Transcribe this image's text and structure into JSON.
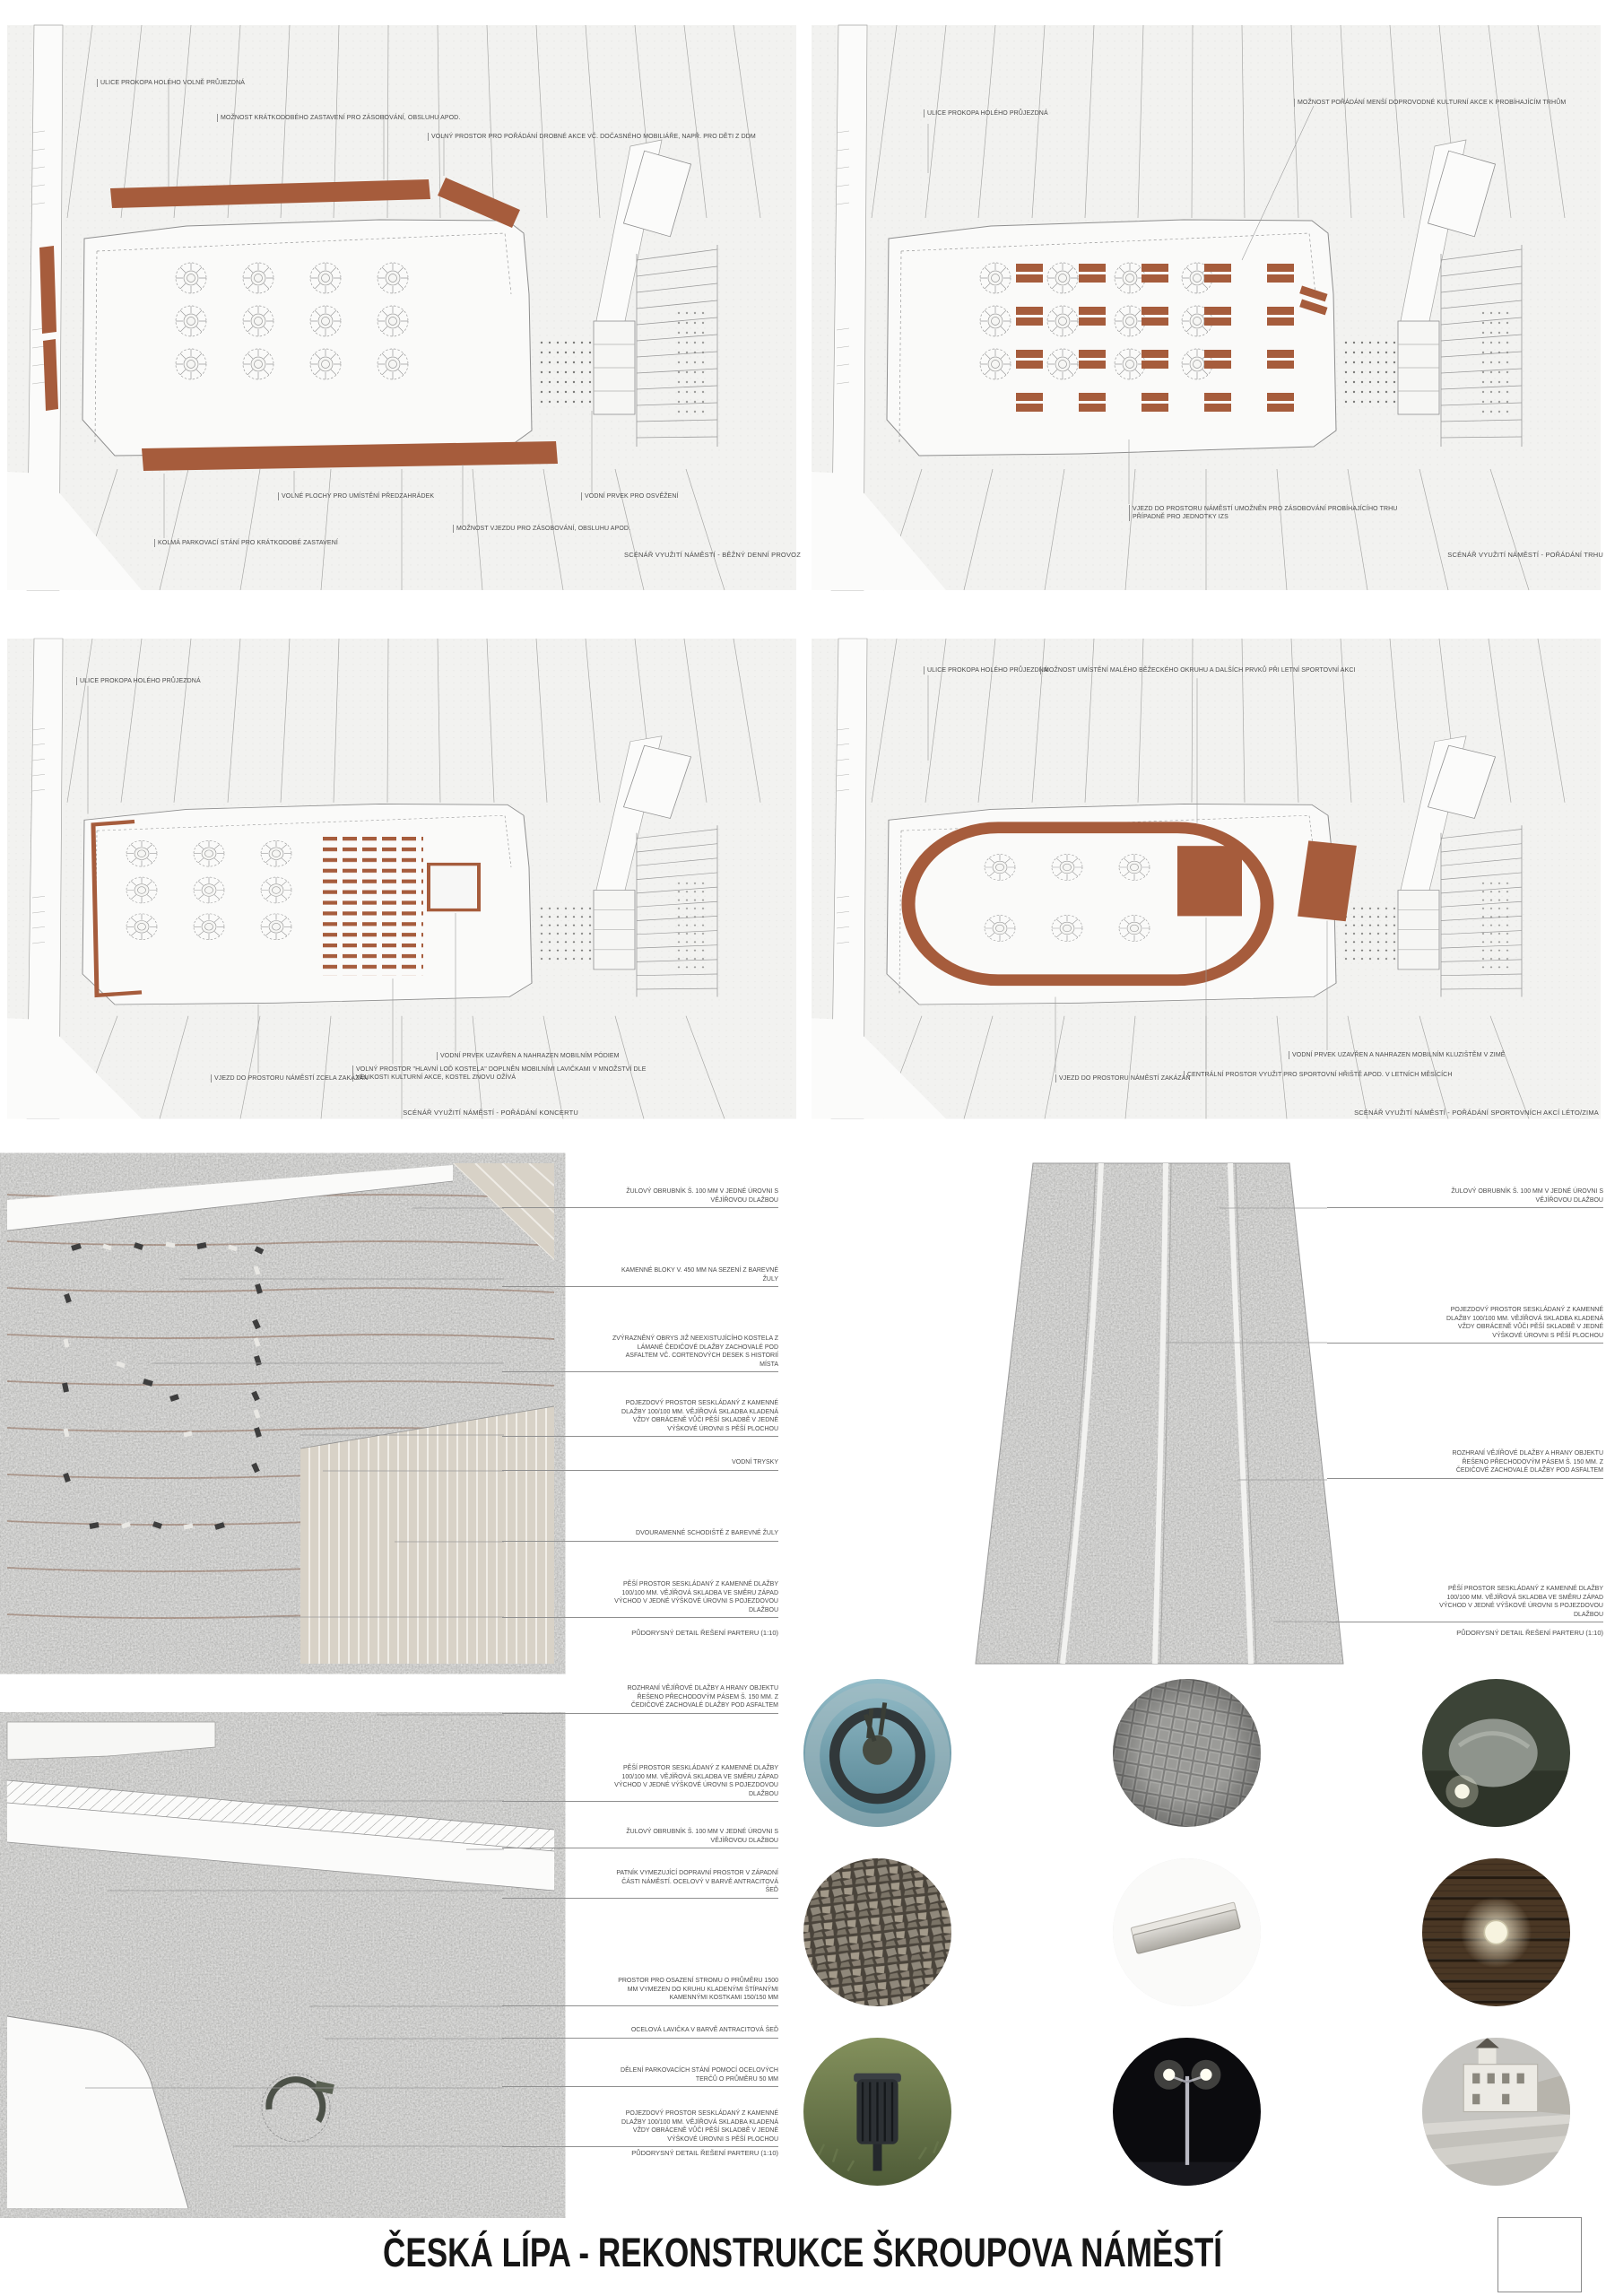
{
  "board": {
    "title": "ČESKÁ LÍPA - REKONSTRUKCE ŠKROUPOVA NÁMĚSTÍ",
    "colors": {
      "accent": "#A65C3C",
      "plan_background": "#F2F2F0",
      "label_text": "#4B4B4B",
      "granite_gray": "#9A9A97",
      "stair_beige": "#D8D2C7"
    }
  },
  "scenarios": [
    {
      "name": "bezny-denni-provoz",
      "caption": "SCÉNÁŘ VYUŽITÍ NÁMĚSTÍ - BĚŽNÝ DENNÍ PROVOZ",
      "labels": [
        "ULICE PROKOPA HOLÉHO VOLNĚ PRŮJEZDNÁ",
        "MOŽNOST KRÁTKODOBÉHO ZASTAVENÍ PRO ZÁSOBOVÁNÍ, OBSLUHU APOD.",
        "VOLNÝ PROSTOR PRO POŘÁDÁNÍ DROBNÉ AKCE VČ. DOČASNÉHO MOBILIÁŘE, NAPŘ. PRO DĚTI Z DDM",
        "VOLNÉ PLOCHY PRO UMÍSTĚNÍ PŘEDZAHRÁDEK",
        "VODNÍ PRVEK PRO OSVĚŽENÍ",
        "MOŽNOST VJEZDU PRO ZÁSOBOVÁNÍ, OBSLUHU APOD.",
        "KOLMÁ PARKOVACÍ STÁNÍ PRO KRÁTKODOBÉ ZASTAVENÍ"
      ]
    },
    {
      "name": "poradani-trhu",
      "caption": "SCÉNÁŘ VYUŽITÍ NÁMĚSTÍ - POŘÁDÁNÍ TRHU",
      "labels": [
        "ULICE PROKOPA HOLÉHO PRŮJEZDNÁ",
        "MOŽNOST POŘÁDÁNÍ MENŠÍ DOPROVODNÉ KULTURNÍ AKCE K PROBÍHAJÍCÍM TRHŮM",
        "VJEZD DO PROSTORU NÁMĚSTÍ UMOŽNĚN PRO ZÁSOBOVÁNÍ PROBÍHAJÍCÍHO TRHU PŘÍPADNĚ PRO JEDNOTKY IZS"
      ]
    },
    {
      "name": "poradani-koncertu",
      "caption": "SCÉNÁŘ VYUŽITÍ NÁMĚSTÍ - POŘÁDÁNÍ KONCERTU",
      "labels": [
        "ULICE PROKOPA HOLÉHO PRŮJEZDNÁ",
        "VJEZD DO PROSTORU NÁMĚSTÍ ZCELA ZAKÁZÁN",
        "VOLNÝ PROSTOR \"HLAVNÍ LOĎ KOSTELA\" DOPLNĚN MOBILNÍMI LAVIČKAMI V MNOŽSTVÍ DLE VELIKOSTI KULTURNÍ AKCE, KOSTEL ZNOVU OŽÍVÁ",
        "VODNÍ PRVEK UZAVŘEN A NAHRAZEN MOBILNÍM PÓDIEM"
      ]
    },
    {
      "name": "poradani-sportovnich-akci",
      "caption": "SCÉNÁŘ VYUŽITÍ NÁMĚSTÍ - POŘÁDÁNÍ SPORTOVNÍCH AKCÍ LÉTO/ZIMA",
      "labels": [
        "ULICE PROKOPA HOLÉHO PRŮJEZDNÁ",
        "MOŽNOST UMÍSTĚNÍ MALÉHO BĚŽECKÉHO OKRUHU A DALŠÍCH PRVKŮ PŘI LETNÍ SPORTOVNÍ AKCI",
        "VJEZD DO PROSTORU NÁMĚSTÍ ZAKÁZÁN",
        "CENTRÁLNÍ PROSTOR VYUŽIT PRO SPORTOVNÍ HŘIŠTĚ APOD. V LETNÍCH MĚSÍCÍCH",
        "VODNÍ PRVEK UZAVŘEN A NAHRAZEN MOBILNÍM KLUZIŠTĚM V ZIMĚ"
      ]
    }
  ],
  "details": [
    {
      "name": "detail-parteru-zapad",
      "caption": "PŮDORYSNÝ DETAIL ŘEŠENÍ PARTERU (1:10)",
      "labels": [
        "ŽULOVÝ OBRUBNÍK Š. 100 MM V JEDNÉ ÚROVNI S VĚJÍŘOVOU DLAŽBOU",
        "KAMENNÉ BLOKY V. 450 MM NA SEZENÍ Z BAREVNÉ ŽULY",
        "ZVÝRAZNĚNÝ OBRYS JIŽ NEEXISTUJÍCÍHO KOSTELA Z LÁMANÉ ČEDIČOVÉ DLAŽBY ZACHOVALÉ POD ASFALTEM VČ. CORTENOVÝCH DESEK S HISTORIÍ MÍSTA",
        "POJEZDOVÝ PROSTOR SESKLÁDANÝ Z KAMENNÉ DLAŽBY 100/100 MM. VĚJÍŘOVÁ SKLADBA KLADENÁ VŽDY OBRÁCENĚ VŮČI PĚŠÍ SKLADBĚ V JEDNÉ VÝŠKOVÉ ÚROVNI S PĚŠÍ PLOCHOU",
        "VODNÍ TRYSKY",
        "DVOURAMENNÉ SCHODIŠTĚ Z BAREVNÉ ŽULY",
        "PĚŠÍ PROSTOR SESKLÁDANÝ Z KAMENNÉ DLAŽBY 100/100 MM. VĚJÍŘOVÁ SKLADBA VE SMĚRU ZÁPAD VÝCHOD V JEDNÉ VÝŠKOVÉ ÚROVNI S POJEZDOVOU DLAŽBOU"
      ]
    },
    {
      "name": "detail-parteru-pas",
      "caption": "PŮDORYSNÝ DETAIL ŘEŠENÍ PARTERU (1:10)",
      "labels": [
        "ŽULOVÝ OBRUBNÍK Š. 100 MM V JEDNÉ ÚROVNI S VĚJÍŘOVOU DLAŽBOU",
        "POJEZDOVÝ PROSTOR SESKLÁDANÝ Z KAMENNÉ DLAŽBY 100/100 MM. VĚJÍŘOVÁ SKLADBA KLADENÁ VŽDY OBRÁCENĚ VŮČI PĚŠÍ SKLADBĚ V JEDNÉ VÝŠKOVÉ ÚROVNI S PĚŠÍ PLOCHOU",
        "ROZHRANÍ VĚJÍŘOVÉ DLAŽBY A HRANY OBJEKTU ŘEŠENO PŘECHODOVÝM PÁSEM Š. 150 MM. Z ČEDIČOVÉ ZACHOVALÉ DLAŽBY POD ASFALTEM",
        "PĚŠÍ PROSTOR SESKLÁDANÝ Z KAMENNÉ DLAŽBY 100/100 MM. VĚJÍŘOVÁ SKLADBA VE SMĚRU ZÁPAD VÝCHOD V JEDNÉ VÝŠKOVÉ ÚROVNI S POJEZDOVOU DLAŽBOU"
      ]
    },
    {
      "name": "detail-parteru-parkovani",
      "caption": "PŮDORYSNÝ DETAIL ŘEŠENÍ PARTERU (1:10)",
      "labels": [
        "ROZHRANÍ VĚJÍŘOVÉ DLAŽBY A HRANY OBJEKTU ŘEŠENO PŘECHODOVÝM PÁSEM Š. 150 MM. Z ČEDIČOVÉ ZACHOVALÉ DLAŽBY POD ASFALTEM",
        "PĚŠÍ PROSTOR SESKLÁDANÝ Z KAMENNÉ DLAŽBY 100/100 MM. VĚJÍŘOVÁ SKLADBA VE SMĚRU ZÁPAD VÝCHOD V JEDNÉ VÝŠKOVÉ ÚROVNI S POJEZDOVOU DLAŽBOU",
        "ŽULOVÝ OBRUBNÍK Š. 100 MM V JEDNÉ ÚROVNI S VĚJÍŘOVOU DLAŽBOU",
        "PATNÍK VYMEZUJÍCÍ DOPRAVNÍ PROSTOR V ZÁPADNÍ ČÁSTI NÁMĚSTÍ. OCELOVÝ V BARVĚ ANTRACITOVÁ ŠEĎ",
        "PROSTOR PRO OSAZENÍ STROMU O PRŮMĚRU 1500 MM VYMEZEN DO KRUHU KLADENÝMI ŠTÍPANÝMI KAMENNÝMI KOSTKAMI 150/150 MM",
        "OCELOVÁ LAVIČKA V BARVĚ ANTRACITOVÁ ŠEĎ",
        "DĚLENÍ PARKOVACÍCH STÁNÍ POMOCÍ OCELOVÝCH TERČŮ O PRŮMĚRU 50 MM",
        "POJEZDOVÝ PROSTOR SESKLÁDANÝ Z KAMENNÉ DLAŽBY 100/100 MM. VĚJÍŘOVÁ SKLADBA KLADENÁ VŽDY OBRÁCENĚ VŮČI PĚŠÍ SKLADBĚ V JEDNÉ VÝŠKOVÉ ÚROVNI S PĚŠÍ PLOCHOU"
      ]
    }
  ],
  "photos": [
    {
      "name": "tree-with-circular-bench"
    },
    {
      "name": "cobblestone-paving"
    },
    {
      "name": "stone-with-ground-light"
    },
    {
      "name": "split-stone-paving"
    },
    {
      "name": "granite-curb-element"
    },
    {
      "name": "deck-recessed-light"
    },
    {
      "name": "steel-litter-bin"
    },
    {
      "name": "street-lighting-night"
    },
    {
      "name": "town-square-stairs"
    }
  ]
}
